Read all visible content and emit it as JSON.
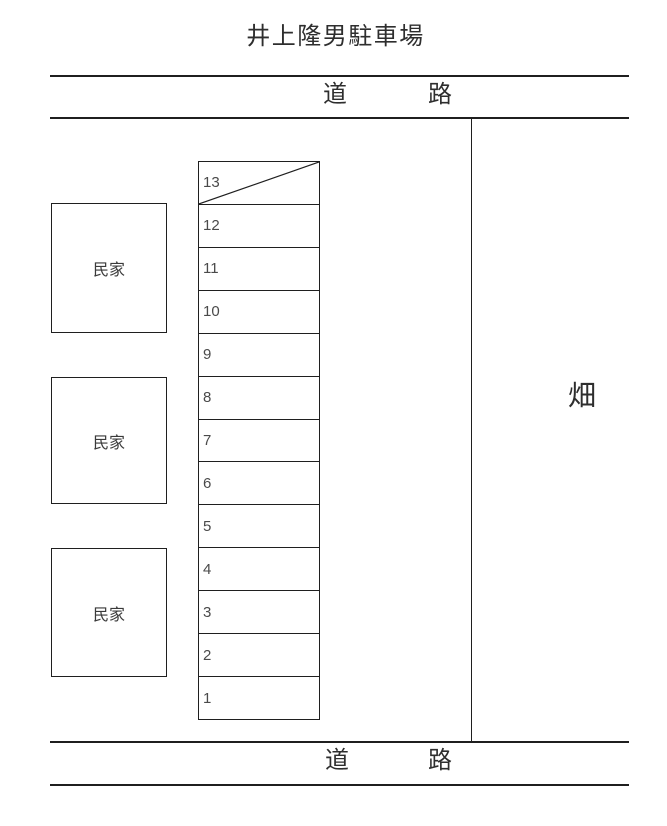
{
  "title": "井上隆男駐車場",
  "road_top": {
    "left_char": "道",
    "right_char": "路"
  },
  "road_bottom": {
    "left_char": "道",
    "right_char": "路"
  },
  "field": {
    "label": "畑"
  },
  "houses": [
    {
      "label": "民家"
    },
    {
      "label": "民家"
    },
    {
      "label": "民家"
    }
  ],
  "parking": {
    "spaces": [
      {
        "number": "13",
        "crossed": true
      },
      {
        "number": "12",
        "crossed": false
      },
      {
        "number": "11",
        "crossed": false
      },
      {
        "number": "10",
        "crossed": false
      },
      {
        "number": "9",
        "crossed": false
      },
      {
        "number": "8",
        "crossed": false
      },
      {
        "number": "7",
        "crossed": false
      },
      {
        "number": "6",
        "crossed": false
      },
      {
        "number": "5",
        "crossed": false
      },
      {
        "number": "4",
        "crossed": false
      },
      {
        "number": "3",
        "crossed": false
      },
      {
        "number": "2",
        "crossed": false
      },
      {
        "number": "1",
        "crossed": false
      }
    ]
  },
  "colors": {
    "line": "#1f1f1f",
    "text": "#2e2e2e",
    "number": "#4a4a4a"
  }
}
